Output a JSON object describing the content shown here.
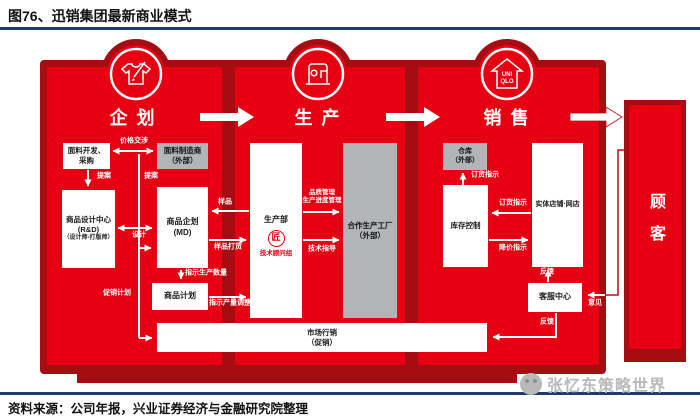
{
  "title": "图76、迅销集团最新商业模式",
  "source": "资料来源：公司年报，兴业证券经济与金融研究院整理",
  "watermark": "张忆东策略世界",
  "stages": {
    "planning": "企 划",
    "production": "生 产",
    "sales": "销 售"
  },
  "customer": "顾客",
  "uniqlo_logo": {
    "line1": "UNI",
    "line2": "QLO"
  },
  "icons": {
    "planning": "tshirt-pencil-icon",
    "production": "sewing-machine-icon",
    "sales": "uniqlo-house-icon"
  },
  "boxes": {
    "fabric_dev": {
      "line1": "面料开发、",
      "line2": "采购"
    },
    "fabric_maker": {
      "line1": "面料制造商",
      "line2": "（外部）"
    },
    "design_center": {
      "line1": "商品设计中心",
      "line2": "(R&D)",
      "line3": "（设计师-打版师）"
    },
    "md": {
      "line1": "商品企划",
      "line2": "(MD)"
    },
    "product_plan": {
      "line1": "商品计划"
    },
    "marketing": {
      "line1": "市场行销",
      "line2": "（促销）"
    },
    "production_dept": {
      "line1": "生产部",
      "stamp": "匠",
      "line2": "技术顾问组"
    },
    "partner_factory": {
      "line1": "合作生产工厂",
      "line2": "（外部）"
    },
    "warehouse": {
      "line1": "仓库",
      "line2": "（外部）"
    },
    "inventory": {
      "line1": "库存控制"
    },
    "stores": {
      "line1": "实体店铺·网店"
    },
    "service": {
      "line1": "客服中心"
    }
  },
  "edge_labels": {
    "price_negotiation": "价格交涉",
    "proposal_left": "提案",
    "proposal_right": "提案",
    "design": "设计",
    "promotion_plan": "促销计划",
    "order_quantity": "指示生产数量",
    "quantity_adjust": "指示产量调整",
    "sample": "样品",
    "sample_order": "样品打货",
    "quality_line1": "品质管理",
    "quality_line2": "生产进度管理",
    "tech_guidance": "技术指导",
    "warehouse_order": "订货指示",
    "store_order": "订货指示",
    "markdown": "降价指示",
    "feedback_up": "反馈",
    "feedback_down": "反馈",
    "opinion": "意见"
  },
  "colors": {
    "red": "#e60012",
    "dark_red": "#a50d12",
    "gray_box": "#b2b5b7",
    "navy_rule": "#1e3a6e",
    "watermark_gray": "#b9b9b9"
  }
}
